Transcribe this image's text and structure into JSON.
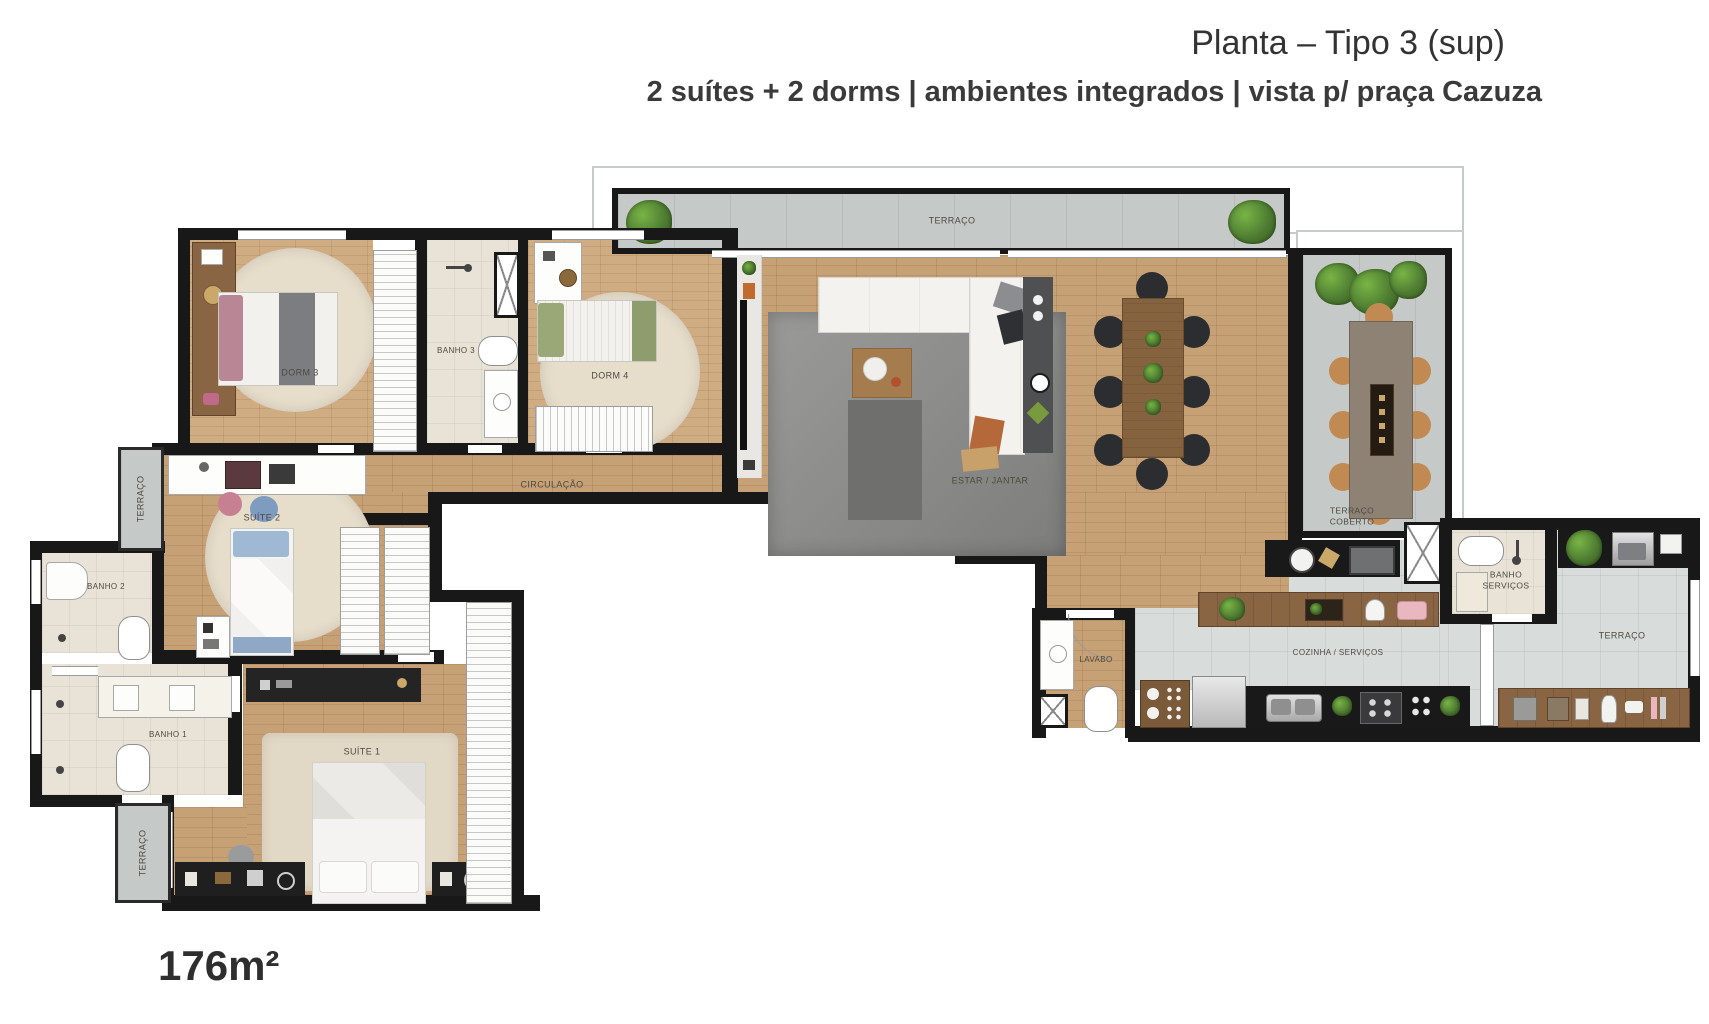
{
  "header": {
    "title": "Planta – Tipo 3 (sup)",
    "subtitle": "2 suítes + 2 dorms | ambientes integrados | vista p/ praça Cazuza"
  },
  "footer": {
    "area": "176m²"
  },
  "floor_plan": {
    "rooms": {
      "terraco_top": "TERRAÇO",
      "dorm3": "DORM 3",
      "banho3": "BANHO 3",
      "dorm4": "DORM 4",
      "estar_jantar": "ESTAR / JANTAR",
      "circulacao": "CIRCULAÇÃO",
      "terraco_coberto": "TERRAÇO COBERTO",
      "suite2": "SUÍTE 2",
      "terraco_esq": "TERRAÇO",
      "banho2": "BANHO 2",
      "banho1": "BANHO 1",
      "suite1": "SUÍTE 1",
      "terraco_inf": "TERRAÇO",
      "lavabo": "LAVABO",
      "cozinha_servicos": "COZINHA / SERVIÇOS",
      "banho_servicos": "BANHO SERVIÇOS",
      "terraco_dir": "TERRAÇO"
    },
    "colors": {
      "wall": "#181818",
      "wood_floor": "#c49b6e",
      "tile_gray": "#d8dcdb",
      "terrace_concrete": "#c5c9c8",
      "bath_tile": "#e8e3d6",
      "plant_green": "#4e7d32",
      "furniture_wood": "#8a6544"
    }
  }
}
